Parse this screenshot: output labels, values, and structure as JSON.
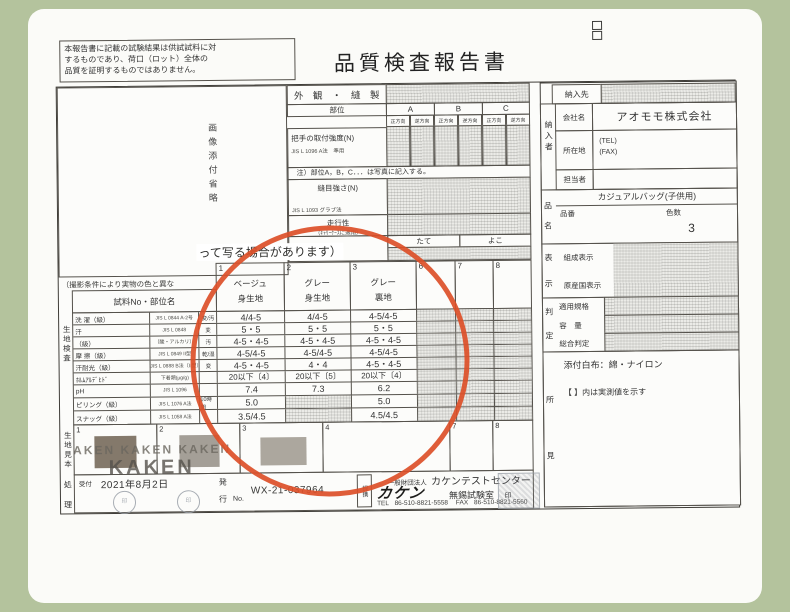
{
  "colors": {
    "background": "#b4c39d",
    "paper": "#fbfbf8",
    "ink": "#333333",
    "annotation": "#dc4f28"
  },
  "disclaimer": {
    "line1": "本報告書に記載の試験結果は供試試料に対",
    "line2": "するものであり、荷口（ロット）全体の",
    "line3": "品質を証明するものではありません。"
  },
  "title": "品質検査報告書",
  "photo": {
    "placeholder": "画像添付省略",
    "caption_start": "（撮影条件により実物の色と異な",
    "caption_end": "って写る場合があります）"
  },
  "appearance": {
    "header": "外　観　・　縫　製",
    "part": "部位",
    "col_a": "A",
    "col_b": "B",
    "col_c": "C",
    "dir_fwd": "正方向",
    "dir_rev": "逆方向",
    "handle_name": "把手の取付強度(N)",
    "handle_std": "JIS L 1096 A法　準用",
    "note": "注）部位A，B，C．．．は写真に記入する。",
    "seam_name": "縫目強さ(N)",
    "seam_std": "JIS L 1093 グラブ法",
    "running_name": "走行性",
    "running_sub": "（ｷｬﾘｰｹｰｽに適用）",
    "warp": "たて",
    "weft": "よこ"
  },
  "fabric": {
    "section": "生地検査",
    "header": "試料No・部位名",
    "columns": [
      {
        "no": "1",
        "line1": "ベージュ",
        "line2": "身生地"
      },
      {
        "no": "2",
        "line1": "グレー",
        "line2": "身生地"
      },
      {
        "no": "3",
        "line1": "グレー",
        "line2": "裏地"
      }
    ],
    "extra_cols": {
      "c6": "6",
      "c7": "7",
      "c8": "8"
    },
    "rows": [
      {
        "name": "洗 濯（級）",
        "std": "JIS L 0844 A-2号",
        "sub": "変/汚",
        "v1": "4/4-5",
        "v2": "4/4-5",
        "v3": "4-5/4-5"
      },
      {
        "name": "汗",
        "std": "JIS L 0848",
        "sub": "変",
        "v1": "5・5",
        "v2": "5・5",
        "v3": "5・5"
      },
      {
        "name": "（級）",
        "std": "（酸・アルカリ）",
        "sub": "汚",
        "v1": "4-5・4-5",
        "v2": "4-5・4-5",
        "v3": "4-5・4-5"
      },
      {
        "name": "摩 擦（級）",
        "std": "JIS L 0849 II型",
        "sub": "乾/湿",
        "v1": "4-5/4-5",
        "v2": "4-5/4-5",
        "v3": "4-5/4-5"
      },
      {
        "name": "汗耐光（級）",
        "std": "JIS L 0888 B法（II型）",
        "sub": "変",
        "v1": "4-5・4-5",
        "v2": "4・4",
        "v3": "4-5・4-5"
      },
      {
        "name": "ﾎﾙﾑｱﾙﾃﾞﾋﾄﾞ",
        "std": "下着類(μg/g)",
        "sub": "",
        "v1": "20以下〔4〕",
        "v2": "20以下〔5〕",
        "v3": "20以下〔4〕"
      },
      {
        "name": "pH",
        "std": "JIS L 1096",
        "sub": "",
        "v1": "7.4",
        "v2": "7.3",
        "v3": "6.2"
      },
      {
        "name": "ピリング（級）",
        "std": "JIS L 1076 A法",
        "sub": "10時間",
        "v1": "5.0",
        "v2": "",
        "v3": "5.0"
      },
      {
        "name": "スナッグ（級）",
        "std": "JIS L 1058 A法",
        "sub": "",
        "v1": "3.5/4.5",
        "v2": "",
        "v3": "4.5/4.5"
      }
    ]
  },
  "samples": {
    "section": "生地見本",
    "cell1": "1",
    "cell2": "2",
    "cell3": "3",
    "cell4": "4",
    "cell7": "7",
    "cell8": "8",
    "watermark_row": "KAKEN  KAKEN  KAKEN",
    "watermark_big": "KAKEN"
  },
  "processing": {
    "section_top": "処",
    "section_bottom": "理",
    "received": "受付",
    "date": "2021年8月2日",
    "issue_top": "発",
    "issue_bottom": "行",
    "no_label": "No.",
    "number": "WX-21-037964"
  },
  "issuer": {
    "org": "一般財団法人",
    "center": "カケンテストセンター",
    "logo": "カケン",
    "affiliate": "提携",
    "lab": "無錫試験室",
    "seal": "印",
    "tel_label": "TEL",
    "tel": "86-510-8821-5558",
    "fax_label": "FAX",
    "fax": "86-510-8821-5560"
  },
  "delivery": {
    "dest": "納入先",
    "supplier": "納入者",
    "company_label": "会社名",
    "company": "アオモモ株式会社",
    "address_label": "所在地",
    "tel": "(TEL)",
    "fax": "(FAX)",
    "person_label": "担当者"
  },
  "product": {
    "section_top": "品",
    "section_bottom": "名",
    "name": "カジュアルバッグ(子供用)",
    "code": "品番",
    "colors": "色数",
    "colors_value": "3"
  },
  "labels": {
    "section_top": "表",
    "section_bottom": "示",
    "row1": "組成表示",
    "row2": "原産国表示"
  },
  "judgement": {
    "section_top": "判",
    "section_bottom": "定",
    "row1": "適用規格",
    "row2": "容　量",
    "row3": "総合判定"
  },
  "findings": {
    "section_top": "所",
    "section_bottom": "見",
    "line1": "添付白布：綿・ナイロン",
    "line2": "【 】内は実測値を示す"
  }
}
